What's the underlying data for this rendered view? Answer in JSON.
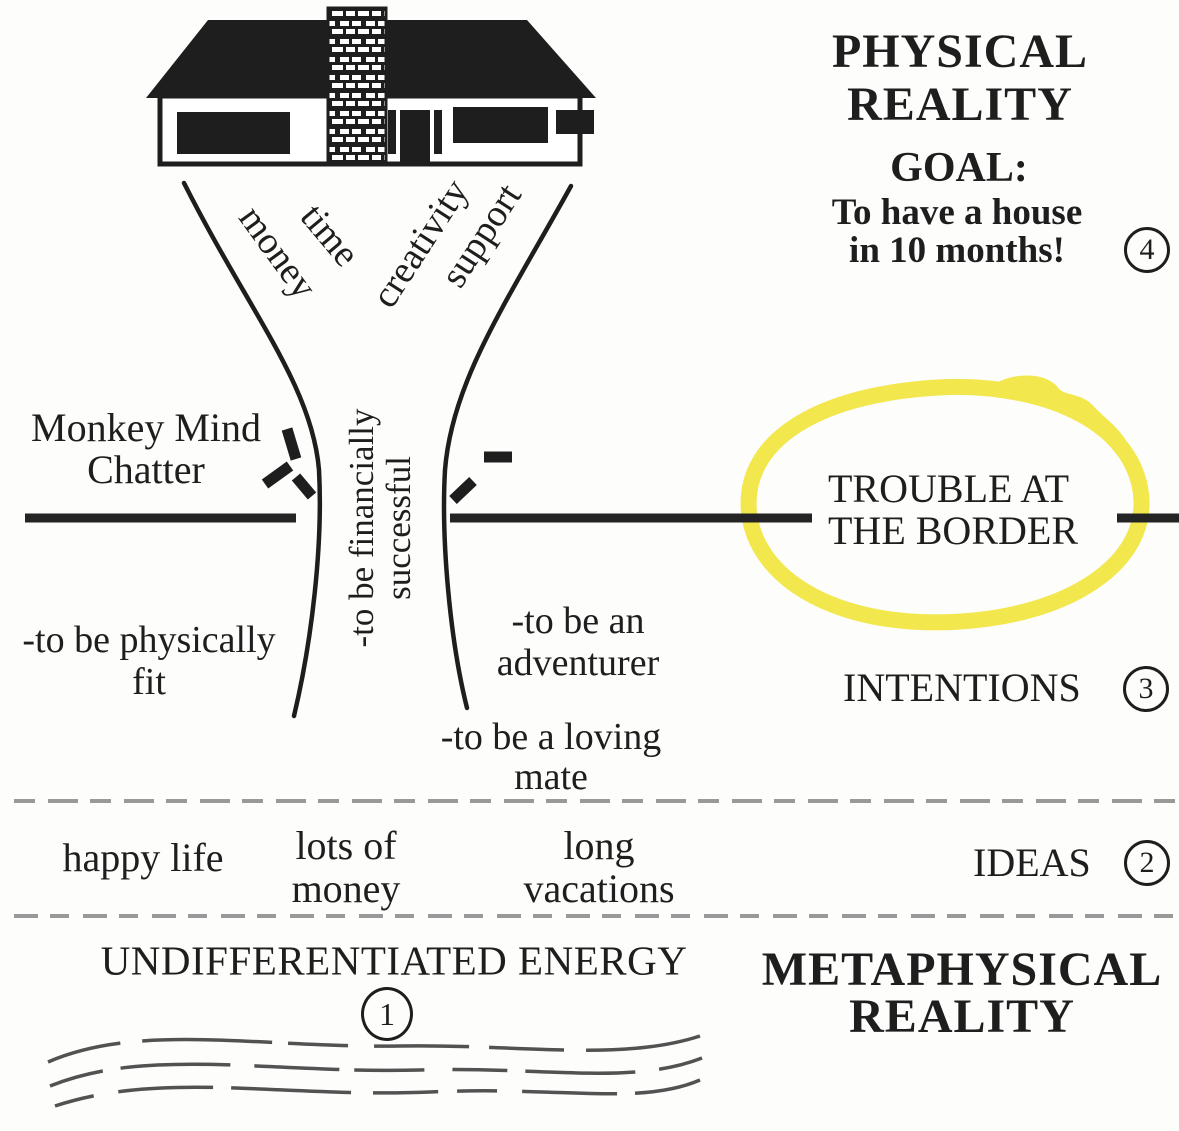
{
  "palette": {
    "ink": "#1e1e1e",
    "separator_gray": "#999999",
    "wave_gray": "#525252",
    "highlighter_yellow": "#f1e436"
  },
  "physical": {
    "title_line1": "PHYSICAL",
    "title_line2": "REALITY",
    "goal_label": "GOAL:",
    "goal_line1": "To have a house",
    "goal_line2": "in 10 months!",
    "step": "4"
  },
  "metaphysical": {
    "title_line1": "METAPHYSICAL",
    "title_line2": "REALITY"
  },
  "border": {
    "trouble_line1": "TROUBLE AT",
    "trouble_line2": "THE BORDER"
  },
  "monkey": {
    "line1": "Monkey Mind",
    "line2": "Chatter"
  },
  "funnel": {
    "input_money": "money",
    "input_time": "time",
    "input_creativity": "creativity",
    "input_support": "support",
    "core_line1": "-to be financially",
    "core_line2": "successful"
  },
  "intentions": {
    "label": "INTENTIONS",
    "step": "3",
    "fit_line1": "-to be physically",
    "fit_line2": "fit",
    "adventurer_line1": "-to be an",
    "adventurer_line2": "adventurer",
    "mate_line1": "-to be a loving",
    "mate_line2": "mate"
  },
  "ideas": {
    "label": "IDEAS",
    "step": "2",
    "idea1": "happy life",
    "idea2_line1": "lots of",
    "idea2_line2": "money",
    "idea3_line1": "long",
    "idea3_line2": "vacations"
  },
  "energy": {
    "label": "UNDIFFERENTIATED ENERGY",
    "step": "1"
  }
}
